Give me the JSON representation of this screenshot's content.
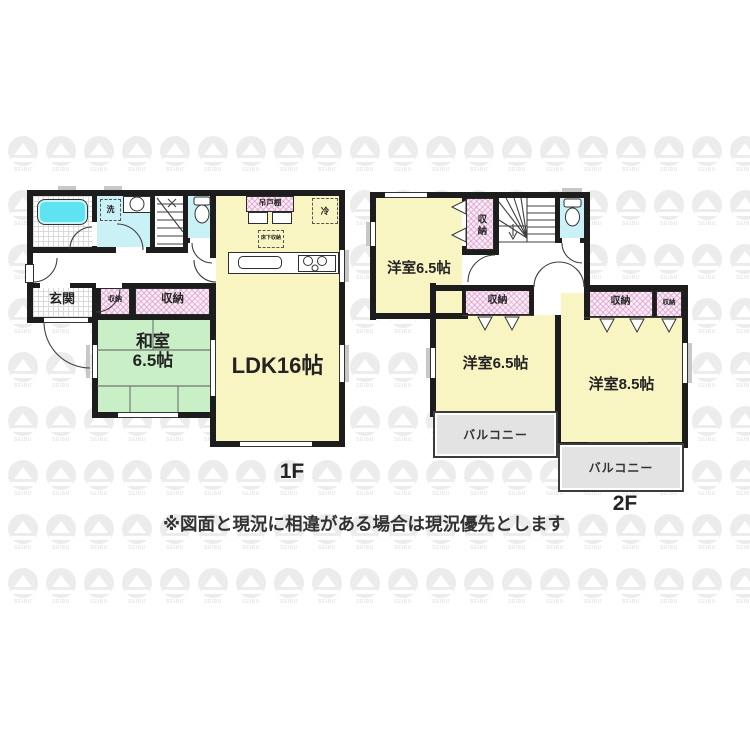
{
  "meta": {
    "floor1_label": "1F",
    "floor2_label": "2F",
    "disclaimer": "※図面と現況に相違がある場合は現況優先とします",
    "watermark_text": "SEIBU"
  },
  "colors": {
    "wall": "#1d1d1d",
    "room_yellow": "#F8F5C2",
    "room_green": "#C9EFC7",
    "water_cyan": "#C9F1F6",
    "bathtub_cyan": "#5FE3F0",
    "closet_pink": "#FAECF6",
    "balcony_gray": "#e3e3e3",
    "watermark_gray": "#ececec"
  },
  "floor1": {
    "genkan": "玄関",
    "washitsu_line1": "和室",
    "washitsu_line2": "6.5帖",
    "ldk": "LDK16帖",
    "laundry_machine": "洗",
    "closet_small": "収納",
    "closet_large": "収納",
    "hanging_cupboard": "吊戸棚",
    "refrigerator": "冷",
    "underfloor_storage": "床下収納"
  },
  "floor2": {
    "bedroom_a": "洋室6.5帖",
    "bedroom_b": "洋室6.5帖",
    "bedroom_c": "洋室8.5帖",
    "closet_vertical": "収納",
    "closet_mid": "収納",
    "closet_big": "収納",
    "closet_small": "収納",
    "balcony_a": "バルコニー",
    "balcony_b": "バルコニー"
  }
}
